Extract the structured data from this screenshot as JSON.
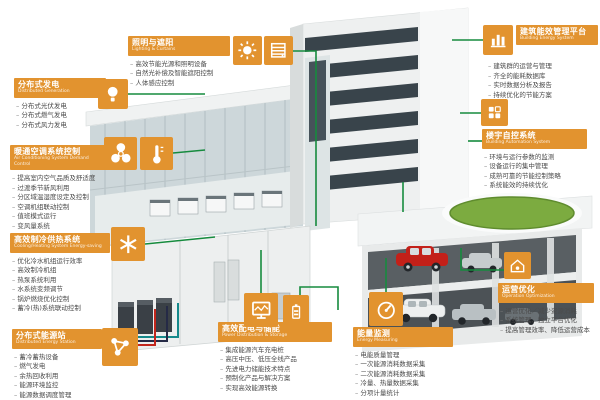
{
  "palette": {
    "accent_orange": "#E2932F",
    "connector_green": "#168B3E",
    "lawn_green": "#7CAB40",
    "pipe_teal": "#15898B",
    "pipe_navy": "#252A46",
    "pipe_red": "#C2271D",
    "item_text": "#4B4B4B"
  },
  "icons": {
    "distributed_generation": "bulb-icon",
    "hvac_fan": "fan-icon",
    "hvac_temperature": "thermometer-icon",
    "cooling_heating": "snowflake-icon",
    "energy_station": "network-icon",
    "lighting_sun": "sun-icon",
    "lighting_blinds": "blinds-icon",
    "power_monitor": "monitor-icon",
    "power_battery": "battery-icon",
    "energy_meter": "meter-icon",
    "energy_platform": "building-chart-icon",
    "building_automation": "dashboard-grid-icon",
    "operation": "house-gauge-icon"
  },
  "panels": {
    "distributed_generation": {
      "title": "分布式发电",
      "subtitle": "Distributed Generation",
      "items": [
        "分布式光伏发电",
        "分布式燃气发电",
        "分布式风力发电"
      ]
    },
    "hvac": {
      "title": "暖通空调系统控制",
      "subtitle": "Air Conditioning System Demand Control",
      "items": [
        "提高室内空气品质及舒适度",
        "过渡季节新风利用",
        "分区域温湿度设定及控制",
        "空调机组联动控制",
        "值班模式运行",
        "变风量系统"
      ]
    },
    "cooling_heating": {
      "title": "高效制冷供热系统",
      "subtitle": "Cooling/Heating System Energy-saving",
      "items": [
        "优化冷水机组运行效率",
        "高效制冷机组",
        "热泵系统利用",
        "水系统变频调节",
        "锅炉燃烧优化控制",
        "蓄冷(热)系统联动控制"
      ]
    },
    "energy_station": {
      "title": "分布式能源站",
      "subtitle": "Distributed Energy Station",
      "items": [
        "蓄冷蓄热设备",
        "燃气发电",
        "余热回收利用",
        "能源环境监控",
        "能源数据调度管理"
      ]
    },
    "lighting": {
      "title": "照明与遮阳",
      "subtitle": "Lighting & Curtains",
      "items": [
        "高效节能光源和照明设备",
        "自然光补偿及智能遮阳控制",
        "人体感应控制"
      ]
    },
    "power_storage": {
      "title": "高效配电与储能",
      "subtitle": "Power Distribution & Storage",
      "items": [
        "集成能源汽车充电桩",
        "高压中压、低压全线产品",
        "先进电力储能技术特点",
        "预制化产品与解决方案",
        "实现高效能源转换"
      ]
    },
    "energy_monitoring": {
      "title": "能量监测",
      "subtitle": "Energy Measuring",
      "items": [
        "电能质量管理",
        "一次能源消耗数据采集",
        "二次能源消耗数据采集",
        "冷量、热量数据采集",
        "分项计量统计"
      ]
    },
    "energy_platform": {
      "title": "建筑能效管理平台",
      "subtitle": "Building Energy System",
      "items": [
        "建筑群的运营与管理",
        "齐全的能耗数据库",
        "实时数据分析及报告",
        "持续优化的节能方案"
      ]
    },
    "building_automation": {
      "title": "楼宇自控系统",
      "subtitle": "Building Automation System",
      "items": [
        "环境与运行参数的监测",
        "设备运行的集中管理",
        "成熟可靠的节能控制策略",
        "系统能效的持续优化"
      ]
    },
    "operation": {
      "title": "运营优化",
      "subtitle": "Operation Optimization",
      "items": [
        "运营优化／减少资源消耗",
        "系统管理、独立平台优化",
        "提高管理效率、降低运营成本"
      ]
    }
  }
}
